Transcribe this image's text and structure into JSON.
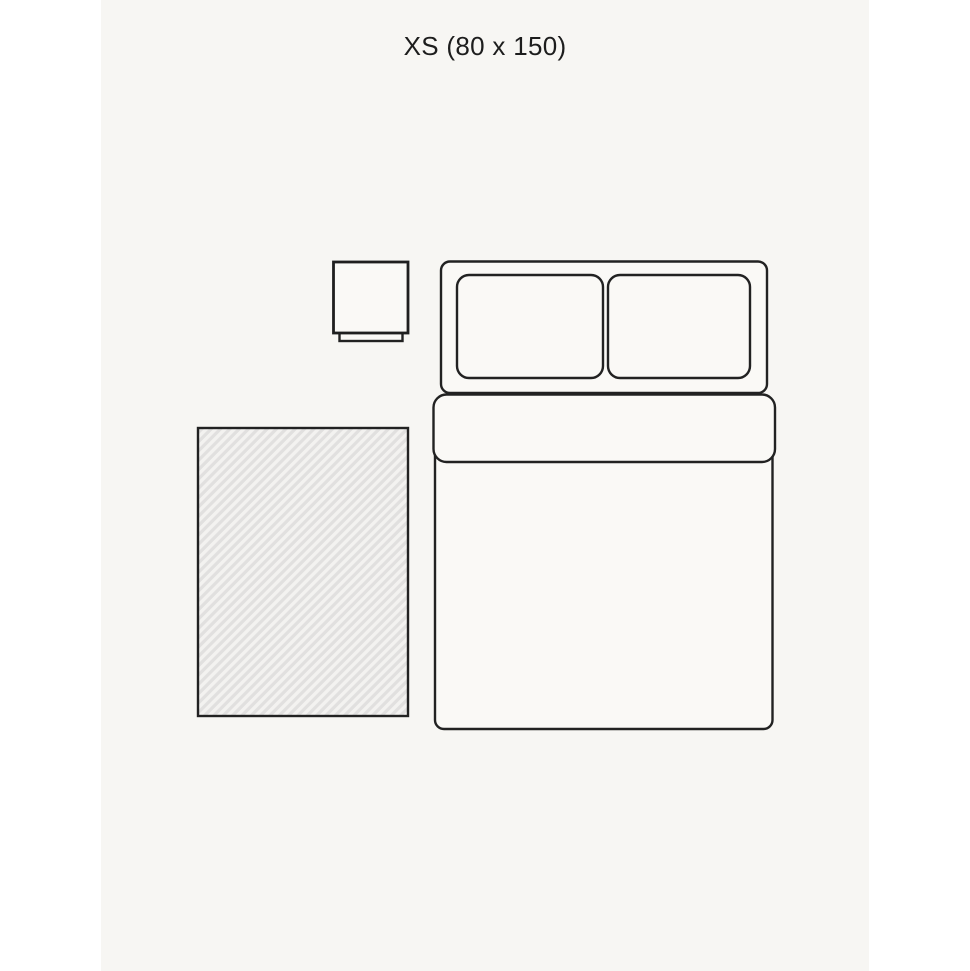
{
  "title": "XS (80 x 150)",
  "size": {
    "code": "XS",
    "dimensions_cm": "80 x 150"
  },
  "colors": {
    "page_background": "#ffffff",
    "panel_background": "#f7f6f3",
    "outline": "#222222",
    "furniture_fill": "#faf9f6",
    "rug_base": "#e1e0df",
    "rug_stripe": "#f3f2f0"
  }
}
